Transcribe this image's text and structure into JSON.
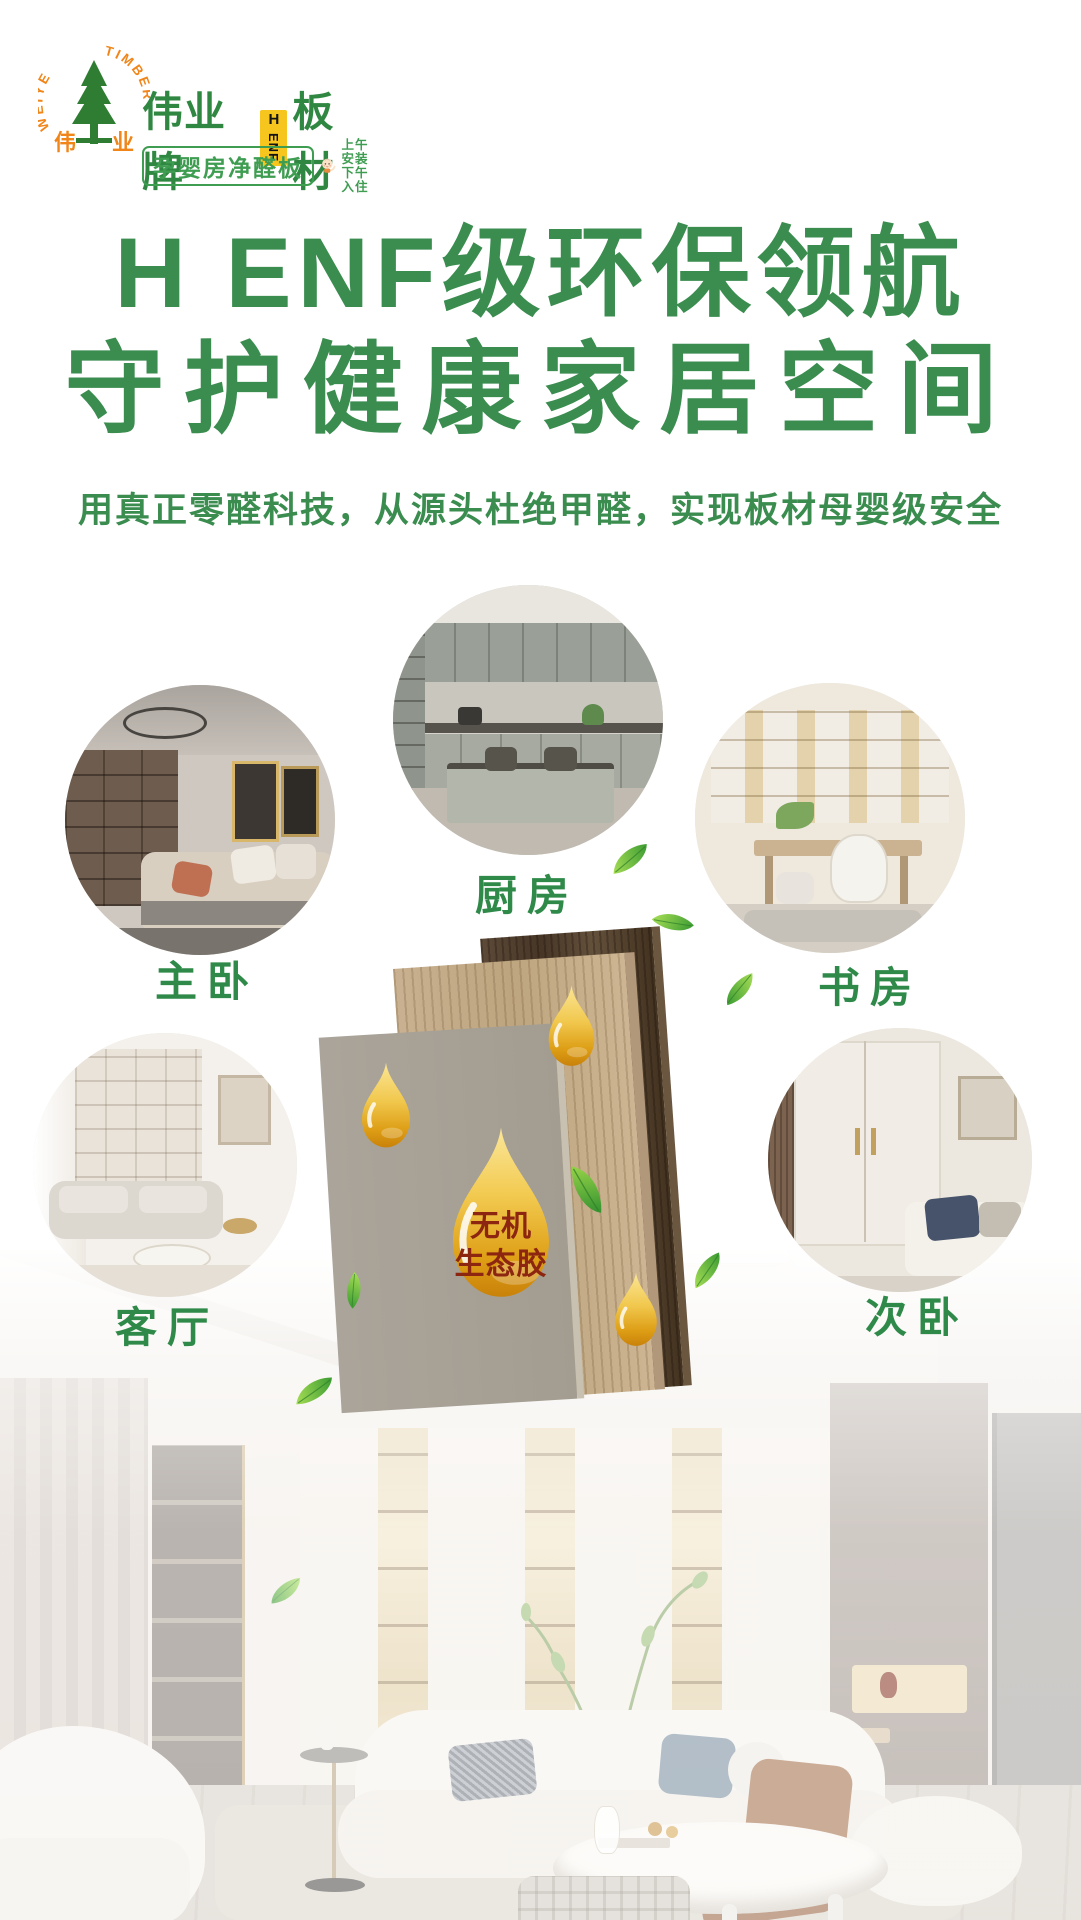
{
  "brand": {
    "arc_left": "WEIYE",
    "arc_right": "TIMBER",
    "tree_caption_left": "伟",
    "tree_caption_right": "业",
    "name_prefix": "伟业牌",
    "badge_top": "H",
    "badge_side": "ENF",
    "name_suffix": "板材",
    "tagline": "孕婴房净醛板",
    "install_line1": "上午安装",
    "install_line2": "下午入住"
  },
  "headline": {
    "line1": "H ENF级环保领航",
    "line2": "守护健康家居空间"
  },
  "subtitle": "用真正零醛科技，从源头杜绝甲醛，实现板材母婴级安全",
  "rooms": [
    {
      "id": "master-bedroom",
      "label": "主卧"
    },
    {
      "id": "kitchen",
      "label": "厨房"
    },
    {
      "id": "study",
      "label": "书房"
    },
    {
      "id": "living-room",
      "label": "客厅"
    },
    {
      "id": "second-bedroom",
      "label": "次卧"
    }
  ],
  "panel_drop": {
    "line1": "无机",
    "line2": "生态胶"
  },
  "colors": {
    "brand_green": "#3a8c4f",
    "label_green": "#2f8a4a",
    "brand_orange": "#f08519",
    "badge_yellow": "#f6c61f",
    "droplet_gold": "#e8b428",
    "droplet_text": "#8c2610",
    "leaf_green": "#52b43a"
  }
}
